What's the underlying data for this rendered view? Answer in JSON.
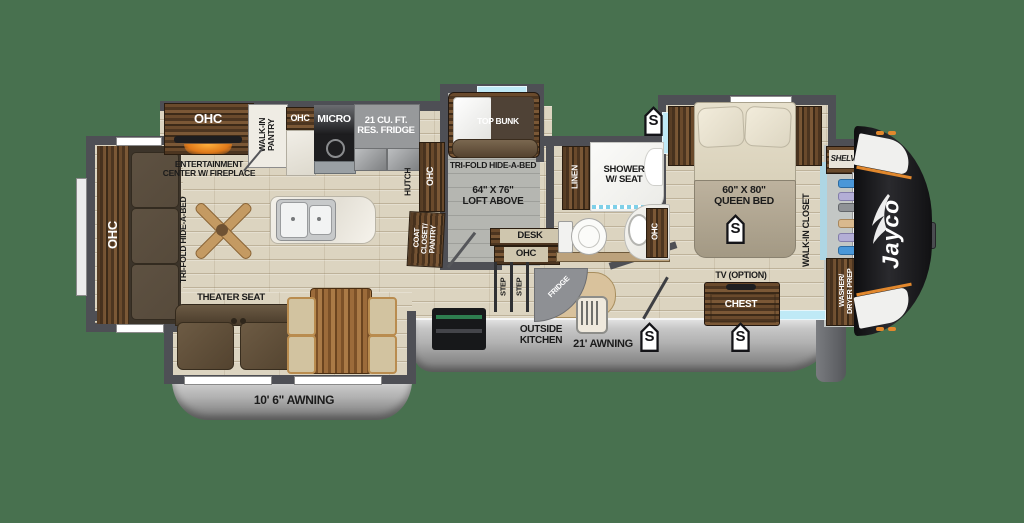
{
  "background": "#48714f",
  "brand": {
    "name": "Jayco"
  },
  "badges": {
    "speaker": "S"
  },
  "living": {
    "ohc_rear": "OHC",
    "tri_fold": "TRI-FOLD HIDE-A-BED",
    "entertainment": "ENTERTAINMENT\nCENTER W/ FIREPLACE",
    "ohc_ent": "OHC",
    "theater_seat": "THEATER SEAT",
    "awning_small": "10' 6\" AWNING"
  },
  "kitchen": {
    "walk_in_pantry": "WALK-IN\nPANTRY",
    "ohc_small": "OHC",
    "micro": "MICRO",
    "res_fridge": "21 CU. FT.\nRES. FRIDGE",
    "hutch": "HUTCH",
    "ohc_hutch": "OHC"
  },
  "bunk_room": {
    "top_bunk": "TOP BUNK",
    "tri_fold": "TRI-FOLD HIDE-A-BED",
    "loft": "64\" X 76\"\nLOFT ABOVE",
    "coat_closet": "COAT\nCLOSET/\nPANTRY",
    "desk": "DESK",
    "ohc_desk": "OHC",
    "step": "STEP"
  },
  "bath": {
    "linen": "LINEN",
    "shower": "SHOWER\nW/ SEAT",
    "ohc_vanity": "OHC"
  },
  "bedroom": {
    "queen_bed": "60\" X 80\"\nQUEEN BED",
    "walk_in_closet": "WALK-IN CLOSET",
    "tv_option": "TV (OPTION)",
    "chest": "CHEST",
    "shelves": "SHELVES",
    "washer_dryer": "WASHER/\nDRYER PREP"
  },
  "exterior": {
    "outside_kitchen": "OUTSIDE\nKITCHEN",
    "awning_big": "21' AWNING",
    "fridge": "FRIDGE"
  }
}
